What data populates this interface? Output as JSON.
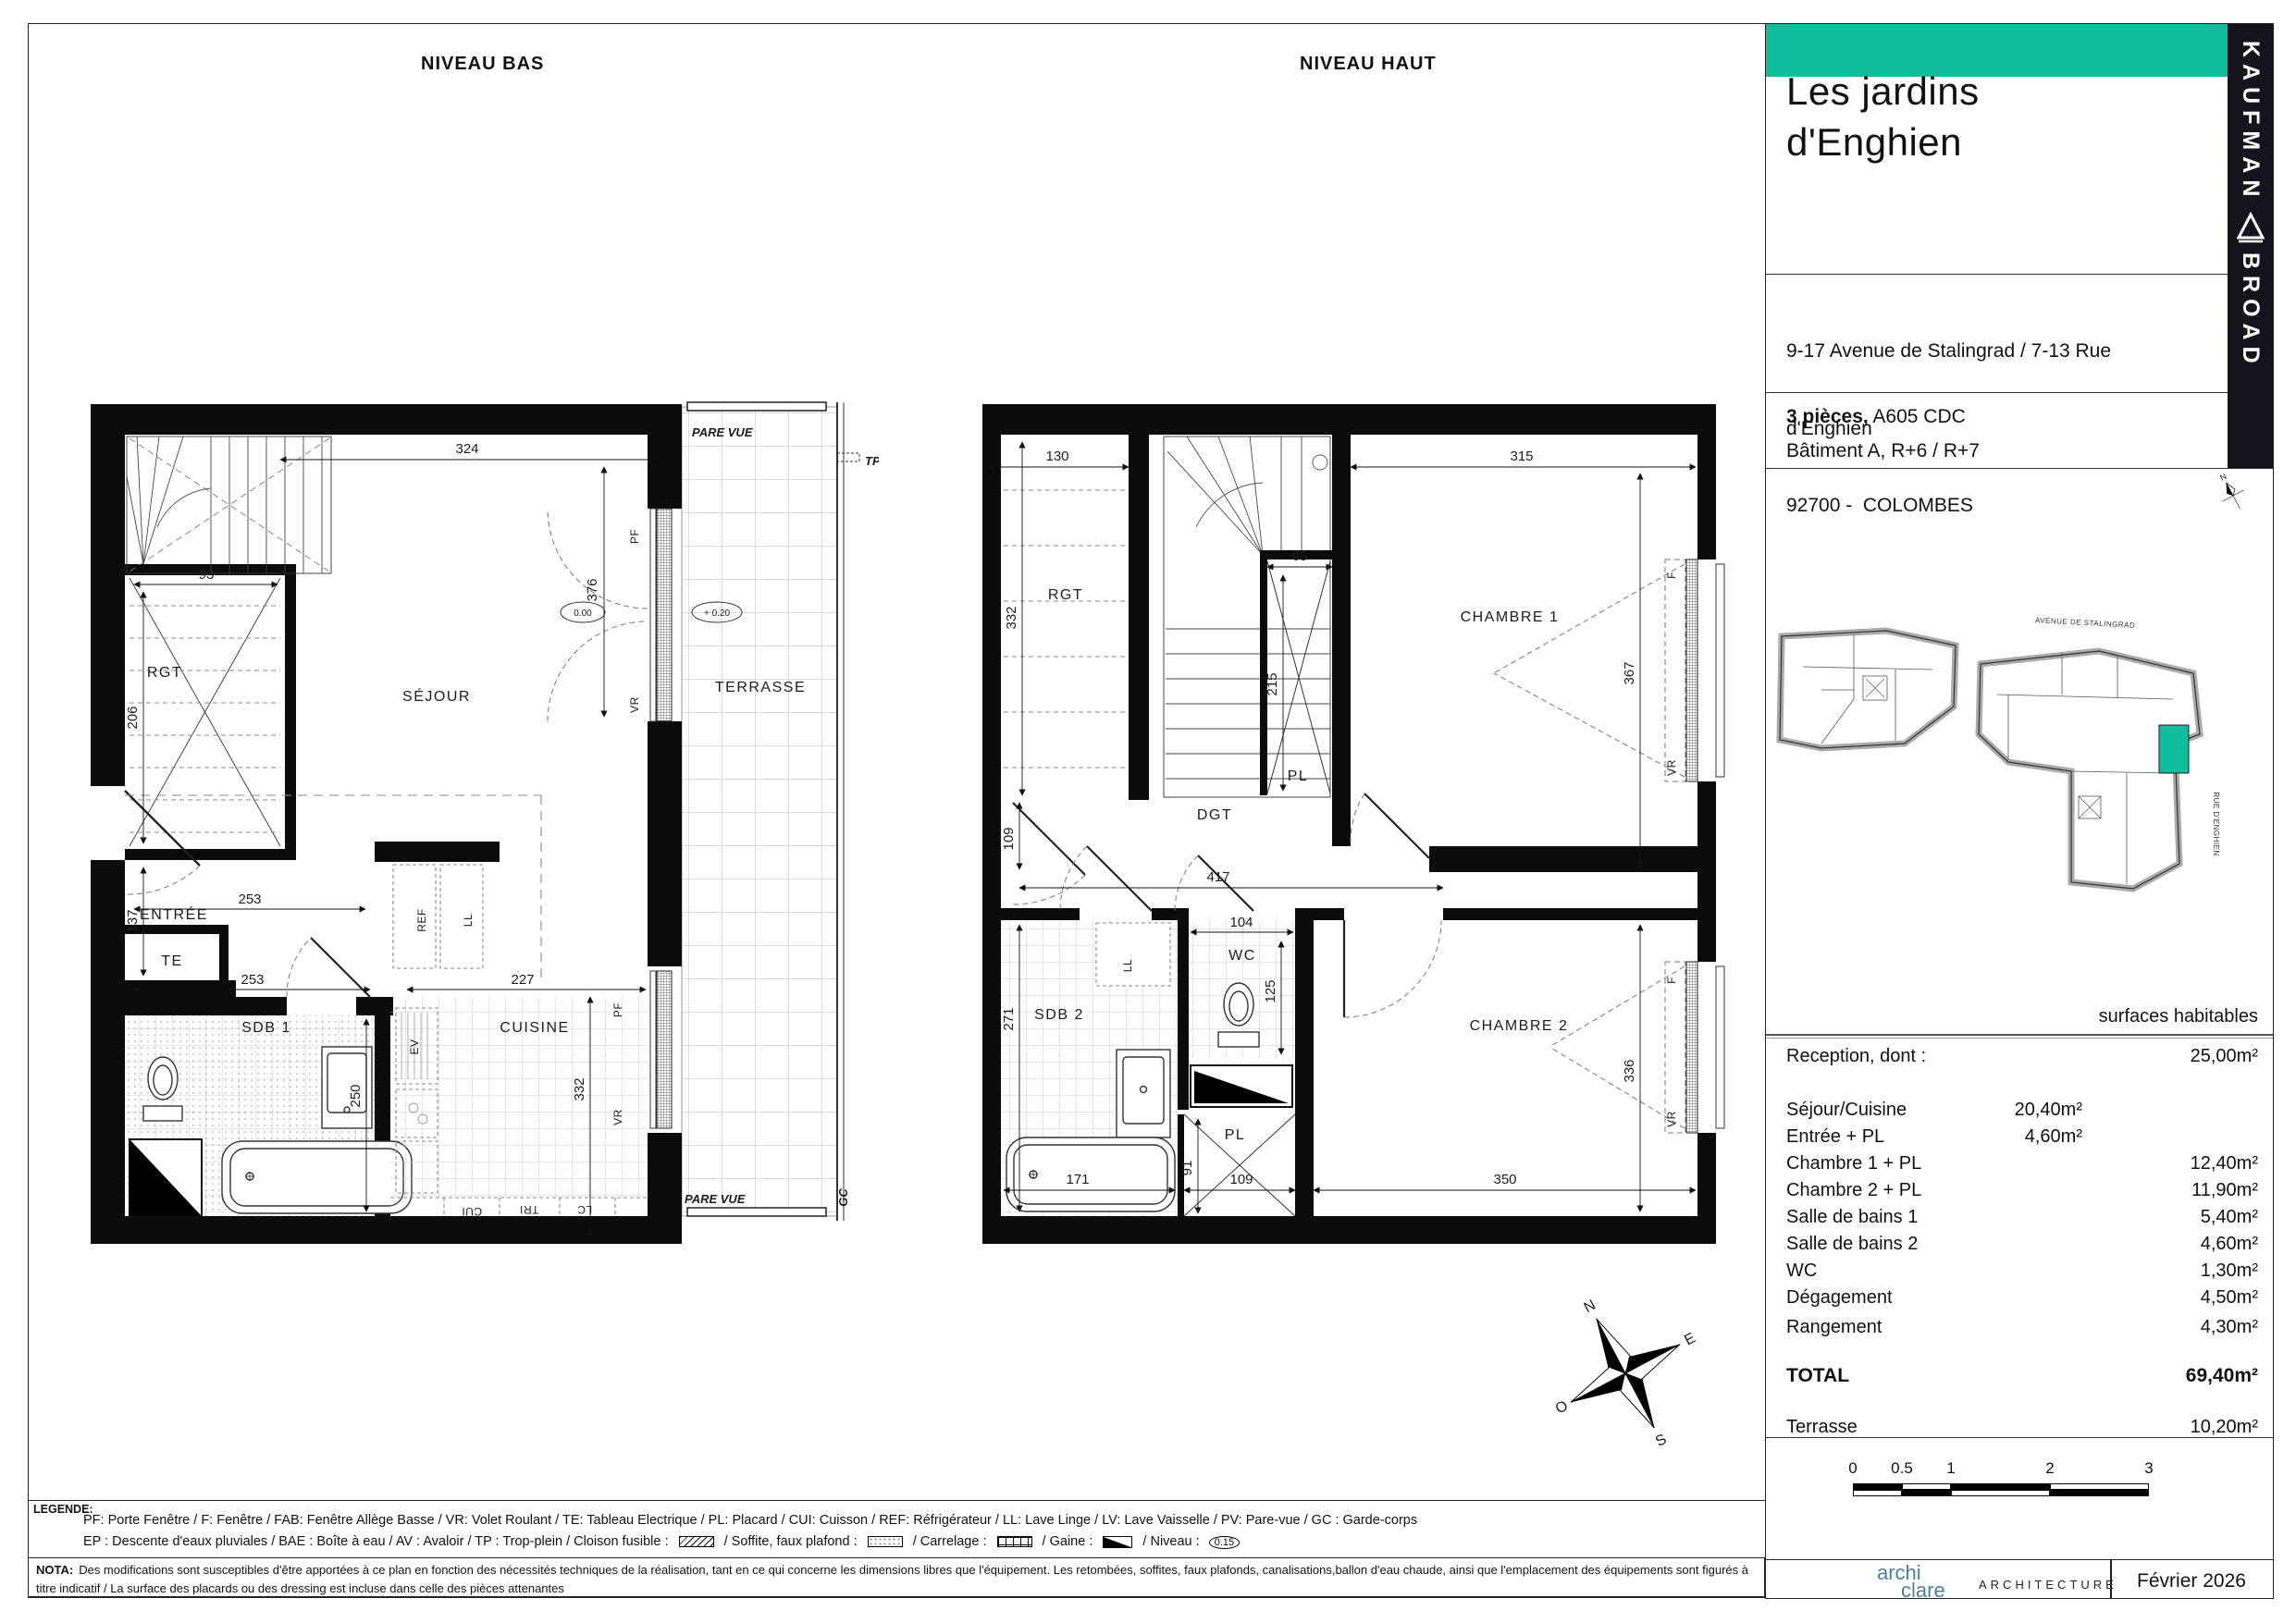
{
  "titles": {
    "bas": "NIVEAU BAS",
    "haut": "NIVEAU HAUT"
  },
  "bas": {
    "rooms": {
      "sejour": "SÉJOUR",
      "terrasse": "TERRASSE",
      "entree": "ENTRÉE",
      "sdb1": "SDB 1",
      "cuisine": "CUISINE",
      "rgt": "RGT",
      "te": "TE"
    },
    "dims": {
      "d324": "324",
      "d93": "93",
      "d206": "206",
      "d376": "376",
      "d137": "137",
      "d253a": "253",
      "d253b": "253",
      "d250": "250",
      "d227": "227",
      "d332": "332"
    },
    "levels": {
      "zero": "0.00",
      "plus20": "+ 0.20"
    },
    "labels": {
      "pare_vue_top": "PARE VUE",
      "pare_vue_bottom": "PARE VUE",
      "tp": "TP",
      "gc": "GC",
      "pf1": "PF",
      "vr1": "VR",
      "pf2": "PF",
      "vr2": "VR",
      "ref": "REF",
      "ll": "LL",
      "ev": "EV",
      "cui": "CUI",
      "tri": "TRI",
      "lc": "LC"
    }
  },
  "haut": {
    "rooms": {
      "rgt": "RGT",
      "chambre1": "CHAMBRE 1",
      "chambre2": "CHAMBRE 2",
      "sdb2": "SDB 2",
      "wc": "WC",
      "dgt": "DGT",
      "pl_top": "PL",
      "pl_bottom": "PL"
    },
    "dims": {
      "d130": "130",
      "d332": "332",
      "d65": "65",
      "d215": "215",
      "d315": "315",
      "d367": "367",
      "d417": "417",
      "d109a": "109",
      "d104": "104",
      "d125": "125",
      "d271": "271",
      "d336": "336",
      "d350": "350",
      "d171": "171",
      "d91": "91",
      "d109b": "109"
    },
    "labels": {
      "f1": "F",
      "vr1": "VR",
      "f2": "F",
      "vr2": "VR",
      "ll": "LL"
    }
  },
  "compass": {
    "n": "N",
    "e": "E",
    "s": "S",
    "o": "O"
  },
  "panel": {
    "brand": {
      "line1": "KAUFMAN",
      "line2": "BROAD"
    },
    "project": {
      "line1": "Les jardins",
      "line2": "d'Enghien"
    },
    "address": {
      "line1": "9-17 Avenue de Stalingrad / 7-13 Rue",
      "line2": "d'Enghien",
      "line3": "92700 -  COLOMBES"
    },
    "unit": {
      "type": "3 pièces,",
      "ref": " A605 CDC",
      "building": "Bâtiment A, R+6 / R+7"
    },
    "keyplan": {
      "avenue": "AVENUE DE STALINGRAD",
      "rue": "RUE D'ENGHIEN",
      "north": "N"
    },
    "surfaces": {
      "header": "surfaces habitables",
      "rows": [
        {
          "label": "Reception, dont :",
          "mid": "",
          "right": "25,00m²"
        },
        {
          "label": "Séjour/Cuisine",
          "mid": "20,40m²",
          "right": ""
        },
        {
          "label": "Entrée + PL",
          "mid": "4,60m²",
          "right": ""
        },
        {
          "label": "Chambre 1 + PL",
          "mid": "",
          "right": "12,40m²"
        },
        {
          "label": "Chambre 2 + PL",
          "mid": "",
          "right": "11,90m²"
        },
        {
          "label": "Salle de bains 1",
          "mid": "",
          "right": "5,40m²"
        },
        {
          "label": "Salle de bains 2",
          "mid": "",
          "right": "4,60m²"
        },
        {
          "label": "WC",
          "mid": "",
          "right": "1,30m²"
        },
        {
          "label": "Dégagement",
          "mid": "",
          "right": "4,50m²"
        },
        {
          "label": "Rangement",
          "mid": "",
          "right": "4,30m²"
        }
      ],
      "total_label": "TOTAL",
      "total_value": "69,40m²",
      "terrace_label": "Terrasse",
      "terrace_value": "10,20m²"
    },
    "scalebar": {
      "t0": "0",
      "t05": "0.5",
      "t1": "1",
      "t2": "2",
      "t3": "3"
    },
    "footer": {
      "logo_top": "archi",
      "logo_bottom": "clare",
      "logo_suffix": "ARCHITECTURE",
      "date": "Février 2026"
    }
  },
  "legend": {
    "title": "LEGENDE:",
    "line1": "PF: Porte Fenêtre  /  F: Fenêtre  /  FAB: Fenêtre Allège Basse  /  VR: Volet Roulant  /  TE: Tableau Electrique  /  PL: Placard  /  CUI: Cuisson  /  REF: Réfrigérateur  /  LL: Lave Linge  /  LV: Lave Vaisselle  /  PV: Pare-vue  /  GC : Garde-corps",
    "line2a": "EP : Descente d'eaux pluviales  /  BAE : Boîte à eau  /  AV : Avaloir  /  TP : Trop-plein  /  Cloison fusible :",
    "line2b": "/  Soffite, faux plafond :",
    "line2c": "/  Carrelage :",
    "line2d": "/  Gaine :",
    "line2e": "/  Niveau :",
    "niveau_value": "0.15",
    "nota_bold": "NOTA:",
    "nota_text": "Des modifications sont susceptibles d'être apportées à ce plan en fonction des nécessités techniques de la réalisation, tant en ce qui concerne les dimensions libres que l'équipement. Les retombées, soffites, faux plafonds, canalisations,ballon d'eau chaude, ainsi que l'emplacement des équipements sont figurés à titre indicatif / La surface des placards ou des dressing est incluse dans celle des pièces attenantes"
  },
  "colors": {
    "teal": "#10BD9D",
    "brand_black": "#14141c",
    "logo_blue": "#4f7f9f"
  }
}
